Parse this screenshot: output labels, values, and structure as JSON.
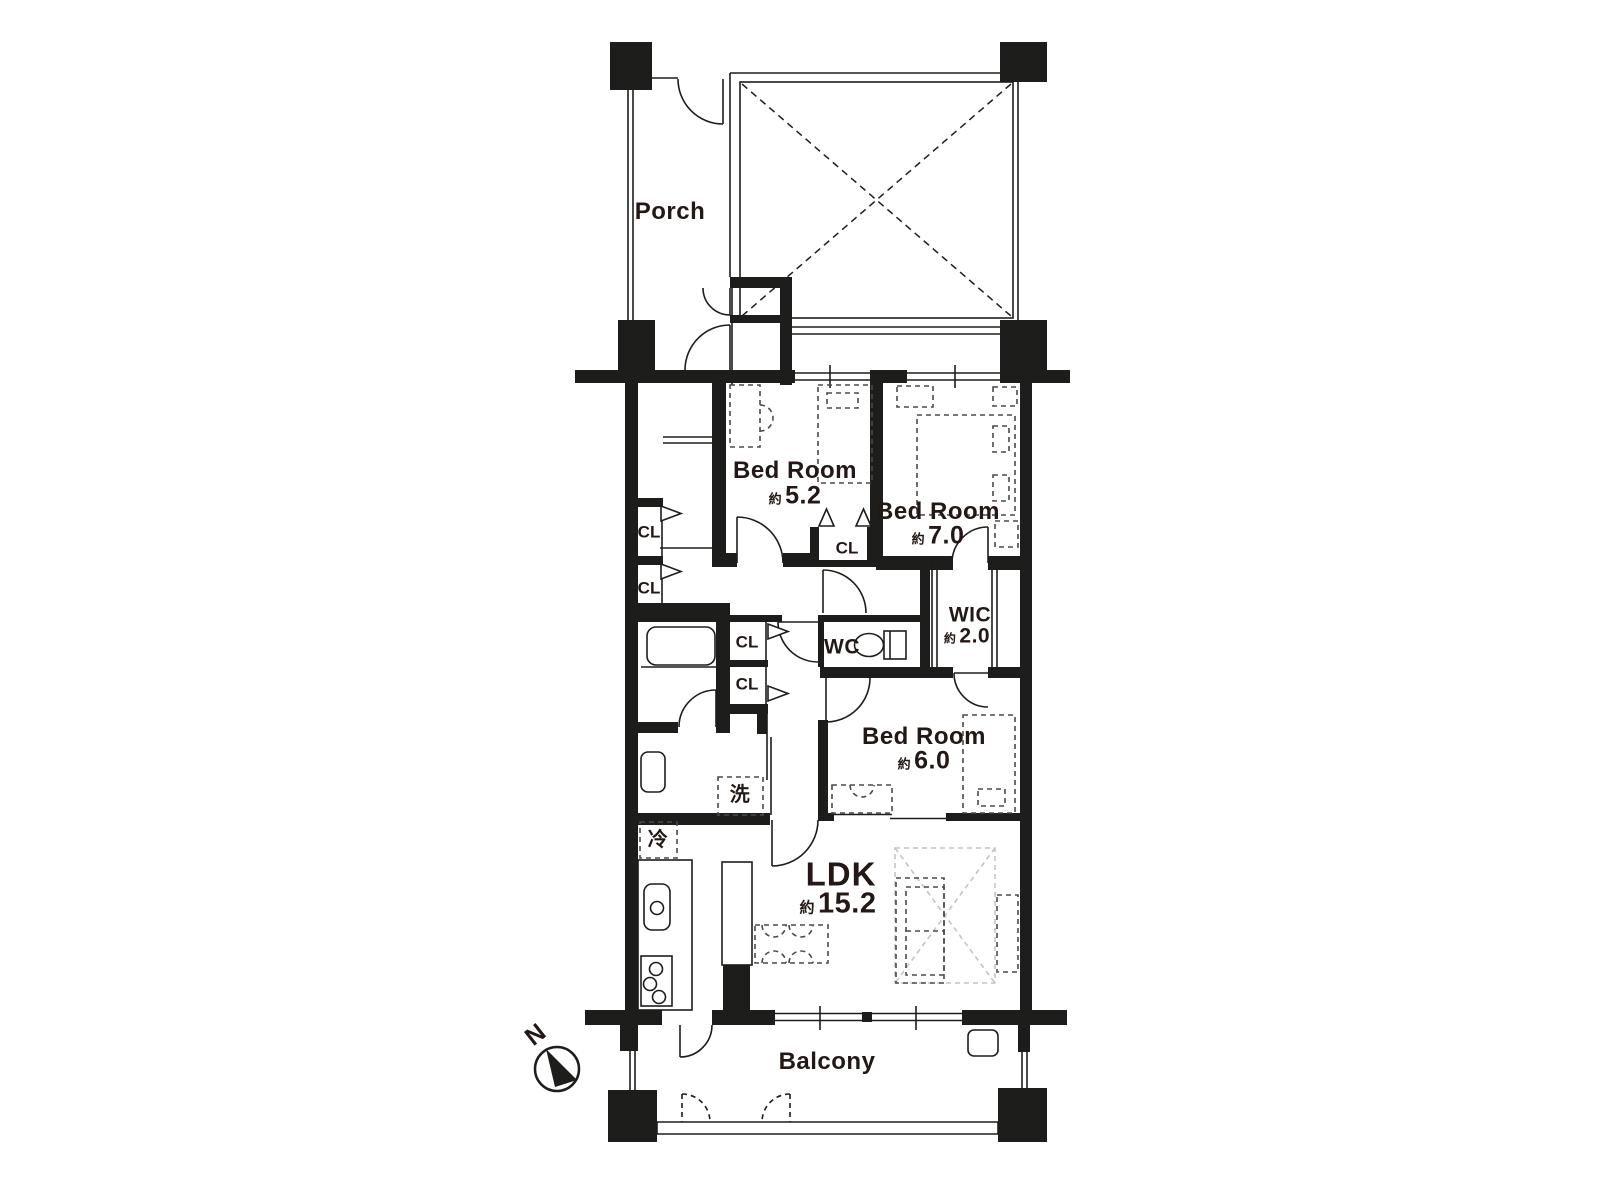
{
  "plan": {
    "rooms": {
      "porch": {
        "name": "Porch"
      },
      "bedroom1": {
        "name": "Bed Room",
        "approx": "約",
        "size": "5.2"
      },
      "bedroom2": {
        "name": "Bed Room",
        "approx": "約",
        "size": "7.0"
      },
      "bedroom3": {
        "name": "Bed Room",
        "approx": "約",
        "size": "6.0"
      },
      "ldk": {
        "name": "LDK",
        "approx": "約",
        "size": "15.2"
      },
      "wic": {
        "name": "WIC",
        "approx": "約",
        "size": "2.0"
      },
      "wc": {
        "name": "WC"
      },
      "balcony": {
        "name": "Balcony"
      }
    },
    "fixtures": {
      "closet": "CL",
      "laundry": "洗",
      "refrigerator": "冷"
    },
    "compass": {
      "north": "N"
    },
    "colors": {
      "wall": "#1d1d1b",
      "text": "#231815",
      "rug": "#c4c4c4"
    }
  }
}
